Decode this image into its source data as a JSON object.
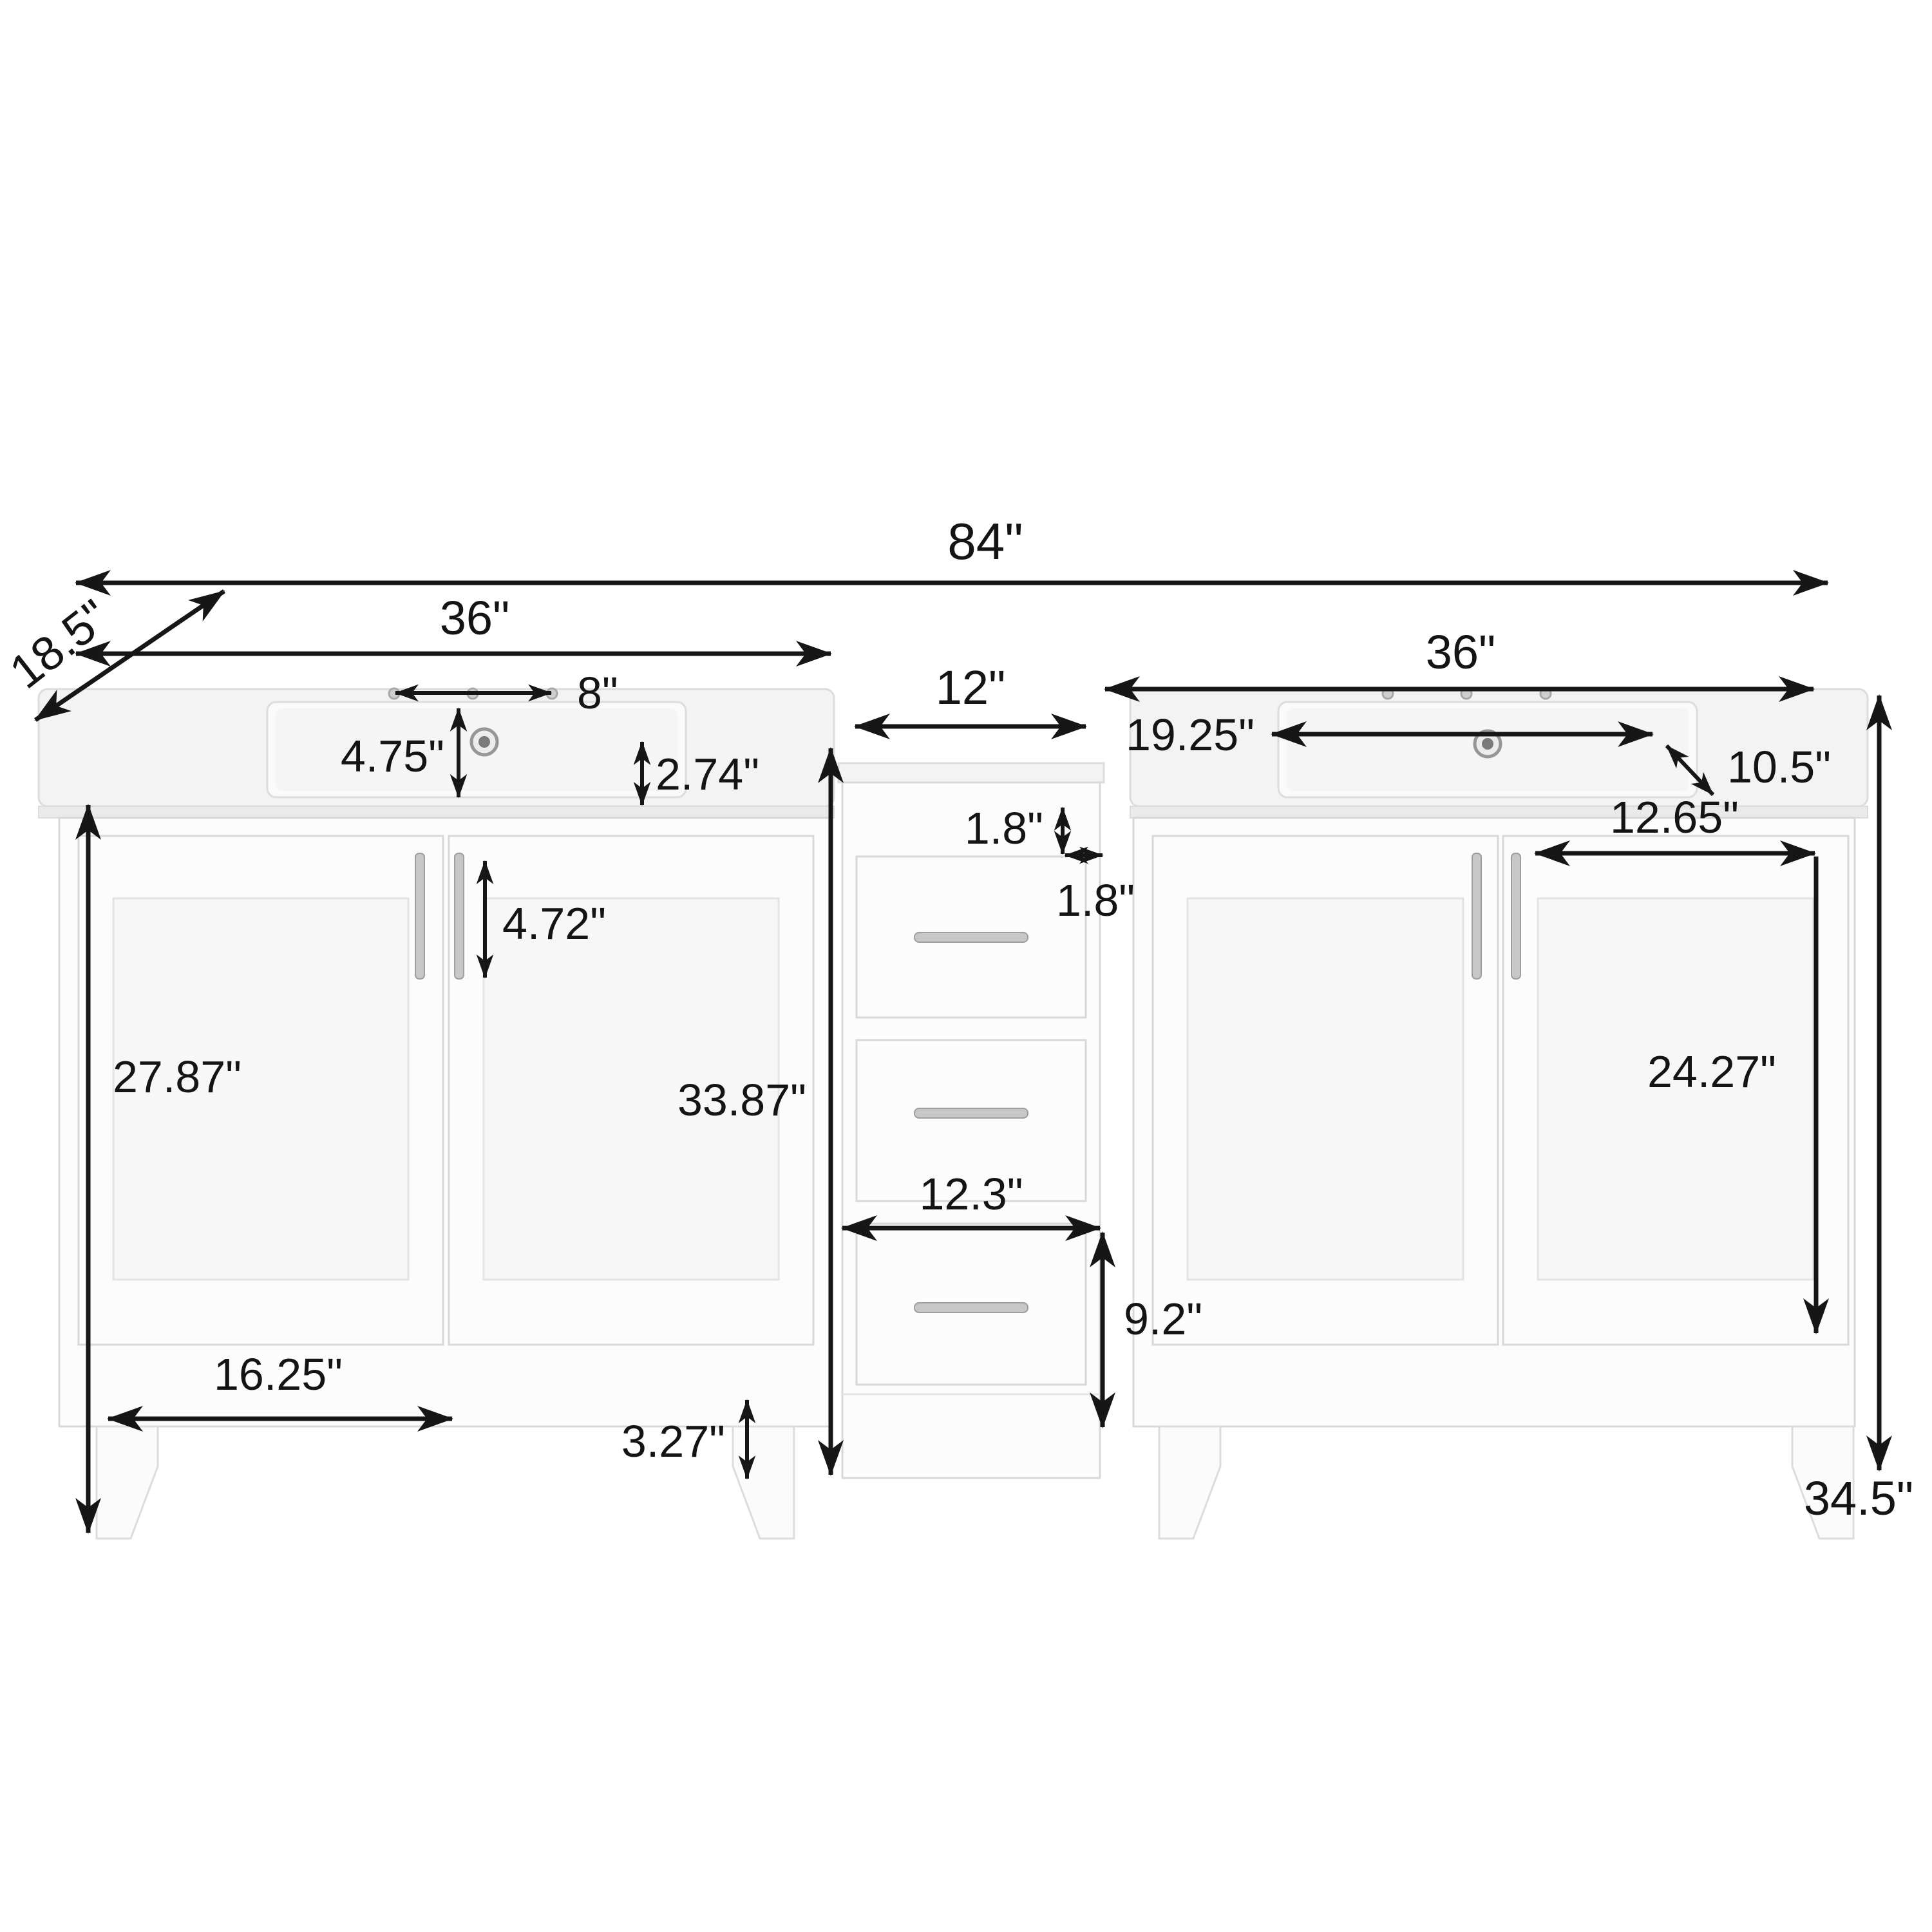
{
  "diagram": {
    "type": "product-dimension-diagram",
    "subject": "84 inch double sink bathroom vanity with middle drawer tower",
    "unit": "inches",
    "dimensions": {
      "overall_width": "84\"",
      "depth": "18.5\"",
      "left_vanity_width": "36\"",
      "middle_cabinet_width": "12\"",
      "right_vanity_width": "36\"",
      "faucet_hole_spread": "8\"",
      "sink_back_offset": "4.75\"",
      "counter_edge_height": "2.74\"",
      "right_counter_offset": "19.25\"",
      "right_basin_depth": "10.5\"",
      "middle_gap_vertical": "1.8\"",
      "middle_gap_horizontal": "1.8\"",
      "handle_length": "4.72\"",
      "right_door_width": "12.65\"",
      "left_door_height": "27.87\"",
      "middle_cabinet_height": "33.87\"",
      "right_door_height": "24.27\"",
      "middle_drawer_width": "12.3\"",
      "middle_lower_section_height": "9.2\"",
      "left_door_panel_width": "16.25\"",
      "toe_kick_height": "3.27\"",
      "overall_height": "34.5\""
    },
    "colors": {
      "arrow": "#161616",
      "cabinet_fill": "#fcfcfc",
      "cabinet_line": "#d8d8d8",
      "counter_fill": "#f3f3f3",
      "handle": "#c7c7c7",
      "background": "#ffffff"
    }
  }
}
